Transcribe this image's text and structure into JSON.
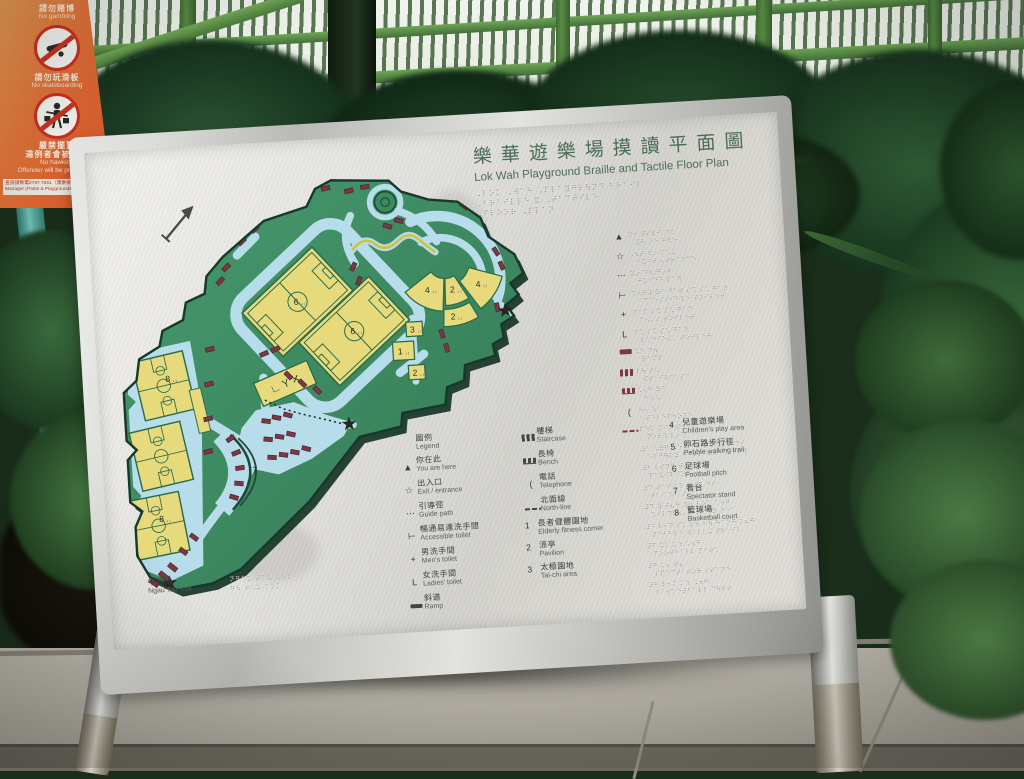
{
  "sign": {
    "title_zh": "樂華遊樂場摸讀平面圖",
    "title_en": "Lok Wah Playground Braille and Tactile Floor Plan",
    "title_braille": [
      "⠠⠇⠕⠅ ⠠⠺⠁⠓ ⠠⠏⠇⠁⠽⠛⠗⠳⠝⠙ ⠃⠗⠁⠊⠇",
      "⠠⠃⠗⠁⠊⠇⠇⠑ ⠯ ⠠⠞⠁⠉⠞⠊⠇⠑",
      "⠠⠋⠇⠕⠕⠗ ⠠⠏⠇⠁⠝"
    ]
  },
  "legend": {
    "header_zh": "圖例",
    "header_en": "Legend",
    "col1": [
      {
        "icon": "you-are-here",
        "zh": "你在此",
        "en": "You are here"
      },
      {
        "icon": "exit",
        "zh": "出入口",
        "en": "Exit / entrance"
      },
      {
        "icon": "guide-path",
        "zh": "引導徑",
        "en": "Guide path"
      },
      {
        "icon": "accessible",
        "zh": "暢通易達洗手間",
        "en": "Accessible toilet"
      },
      {
        "icon": "mens",
        "zh": "男洗手間",
        "en": "Men's toilet"
      },
      {
        "icon": "ladies",
        "zh": "女洗手間",
        "en": "Ladies' toilet"
      },
      {
        "icon": "ramp",
        "zh": "斜道",
        "en": "Ramp"
      }
    ],
    "col2_icons": [
      {
        "icon": "staircase",
        "zh": "樓梯",
        "en": "Staircase"
      },
      {
        "icon": "bench",
        "zh": "長椅",
        "en": "Bench"
      },
      {
        "icon": "telephone",
        "zh": "電話",
        "en": "Telephone"
      },
      {
        "icon": "north-line",
        "zh": "北面線",
        "en": "North-line"
      }
    ],
    "col2_numbered": [
      {
        "num": "1",
        "zh": "長者健體園地",
        "en": "Elderly fitness corner"
      },
      {
        "num": "2",
        "zh": "涼亭",
        "en": "Pavilion"
      },
      {
        "num": "3",
        "zh": "太極園地",
        "en": "Tai-chi area"
      }
    ],
    "col3": [
      {
        "num": "4",
        "zh": "兒童遊樂場",
        "en": "Children's play area"
      },
      {
        "num": "5",
        "zh": "卵石路步行徑",
        "en": "Pebble walking trail"
      },
      {
        "num": "6",
        "zh": "足球場",
        "en": "Football pitch"
      },
      {
        "num": "7",
        "zh": "看台",
        "en": "Spectator stand"
      },
      {
        "num": "8",
        "zh": "籃球場",
        "en": "Basketball court"
      }
    ]
  },
  "braille_panel": {
    "rows": [
      {
        "icon": "you-are-here",
        "l1": "⠝⠊ ⠞⠎⠯⠊ ⠙⠩",
        "l2": "⠽⠳ ⠜⠑ ⠓⠻⠑"
      },
      {
        "icon": "exit",
        "l1": "⠡⠳⠞ ⠫⠔ ⠅⠡⠥",
        "l2": "⠑⠭⠊⠞ ⠢⠞⠗⠁⠝⠉⠑"
      },
      {
        "icon": "guide-path",
        "l1": "⠽⠔ ⠙⠳ ⠛⠔⠛",
        "l2": "⠛⠥⠊⠙⠑ ⠏⠁⠹"
      },
      {
        "icon": "accessible",
        "l1": "⠩⠢⠞⠼ ⠽⠊ ⠙⠁⠞ ⠎⠩ ⠎⠡ ⠛⠁⠝",
        "l2": "⠁⠉⠉⠑⠎⠎⠊⠃⠇⠑ ⠞⠕⠊⠇⠑⠞"
      },
      {
        "icon": "mens",
        "l1": "⠝⠁⠍ ⠎⠩ ⠎⠡ ⠛⠁⠝",
        "l2": "⠍⠢⠄⠎ ⠞⠕⠊⠇⠑⠞"
      },
      {
        "icon": "ladies",
        "l1": "⠝⠩ ⠎⠩ ⠎⠡ ⠛⠁⠝",
        "l2": "⠇⠁⠙⠊⠑⠎⠄ ⠞⠕⠊⠇⠑⠞"
      },
      {
        "icon": "ramp",
        "l1": "⠡⠑ ⠙⠳",
        "l2": "⠗⠁⠍⠏"
      },
      {
        "icon": "staircase",
        "l1": "⠇⠳ ⠞⠡",
        "l2": "⠎⠞⠁⠊⠗⠉⠁⠎⠑"
      },
      {
        "icon": "bench",
        "l1": "⠡⠢⠛ ⠽⠊",
        "l2": "⠃⠢⠡"
      },
      {
        "icon": "telephone",
        "l1": "⠙⠢ ⠱⠁",
        "l2": "⠞⠑⠇⠑⠏⠓⠕⠝⠑"
      },
      {
        "icon": "north-line",
        "l1": "⠏⠑⠅ ⠍⠊⠝ ⠎⠔",
        "l2": "⠝⠕⠗⠹ ⠇⠔⠑"
      },
      {
        "icon": null,
        "l1": "⠼⠁ ⠡⠿⠛ ⠡⠑ ⠅⠂⠝ ⠞⠩ ⠽⠎⠝ ⠙⠊",
        "l2": "⠑⠇⠙⠻⠇⠽ ⠋⠊⠞⠝⠑⠎⠎ ⠉⠕⠗⠝⠻"
      },
      {
        "icon": null,
        "l1": "⠼⠃ ⠇⠎⠝⠛ ⠞⠦⠛",
        "l2": "⠏⠁⠧⠊⠇⠊⠕⠝"
      },
      {
        "icon": null,
        "l1": "⠼⠉ ⠞⠁⠊ ⠅⠇ ⠽⠎⠝ ⠙⠊",
        "l2": "⠞⠁⠊ ⠡⠊ ⠜⠑⠁"
      },
      {
        "icon": null,
        "l1": "⠼⠙ ⠽ ⠞⠦⠛ ⠽⠳ ⠇⠕⠅ ⠡⠲⠛",
        "l2": "⠡⠊⠇⠙⠗⠢⠄⠎ ⠏⠇⠁⠽ ⠜⠑⠁"
      },
      {
        "icon": null,
        "l1": "⠼⠑ ⠇⠂⠝ ⠎⠅ ⠇⠳ ⠃⠳ ⠓⠁⠝⠛ ⠅⠦⠛",
        "l2": "⠏⠑⠃⠃⠇⠑ ⠺⠁⠇⠅⠬ ⠞⠗⠁⠊⠇"
      },
      {
        "icon": null,
        "l1": "⠼⠋ ⠭⠅ ⠅⠱ ⠡⠲⠛",
        "l2": "⠋⠕⠕⠞⠃⠁⠇⠇ ⠏⠊⠞⠡"
      },
      {
        "icon": null,
        "l1": "⠼⠛ ⠅⠦ ⠞⠦",
        "l2": "⠎⠏⠑⠉⠞⠁⠞⠕⠗ ⠎⠞⠁⠝⠙"
      },
      {
        "icon": null,
        "l1": "⠼⠓ ⠇⠂⠍ ⠅⠱ ⠡⠲⠛",
        "l2": "⠃⠁⠎⠅⠑⠞⠃⠁⠇⠇ ⠉⠳⠗⠞"
      }
    ]
  },
  "map": {
    "labels": [
      {
        "t": "6",
        "x": 186,
        "y": 131
      },
      {
        "t": "6",
        "x": 243,
        "y": 165
      },
      {
        "t": "8",
        "x": 48,
        "y": 203
      },
      {
        "t": "8",
        "x": 33,
        "y": 348
      },
      {
        "t": "7",
        "x": 133,
        "y": 303
      },
      {
        "t": "4",
        "x": 323,
        "y": 127
      },
      {
        "t": "4",
        "x": 376,
        "y": 124
      },
      {
        "t": "2",
        "x": 349,
        "y": 128
      },
      {
        "t": "2",
        "x": 348,
        "y": 156
      },
      {
        "t": "2",
        "x": 305,
        "y": 212
      },
      {
        "t": "3",
        "x": 305,
        "y": 167
      },
      {
        "t": "1",
        "x": 291,
        "y": 189
      }
    ],
    "label_braille": "⠰⠆",
    "toilet_glyphs": "∟ Y ✕",
    "exit_zh": "牛頭角",
    "exit_en": "Ngau Tau Kok",
    "exit_braille": [
      "⠝⠛⠁⠥ ⠞⠁⠥ ⠅⠕⠅",
      "⠛⠳ ⠞⠡⠥ ⠅⠕⠅"
    ]
  },
  "warning_sign": {
    "items": [
      {
        "icon": null,
        "zh": "請勿賭博",
        "en": "No gambling"
      },
      {
        "icon": "skateboard",
        "zh": "請勿玩滑板",
        "en": "No skateboarding"
      },
      {
        "icon": "hawker",
        "zh": "嚴禁擺賣",
        "zh2": "違例者會被檢控",
        "en": "No hawking",
        "en2": "Offender will be prosecuted"
      }
    ],
    "fine_print_zh": "查詢請致電2797 7651（康樂場地）辦公時間",
    "fine_print_en": "Manager (Parks & Playgrounds) Kwun Tong District, outside office hours please call 1823."
  },
  "colors": {
    "park_green": "#3d8a61",
    "path_blue": "#b7dcea",
    "court_yellow": "#e7da7c",
    "bench_red": "#7c3644",
    "title_green": "#4a6b58",
    "warning_orange": "#e8763a"
  }
}
